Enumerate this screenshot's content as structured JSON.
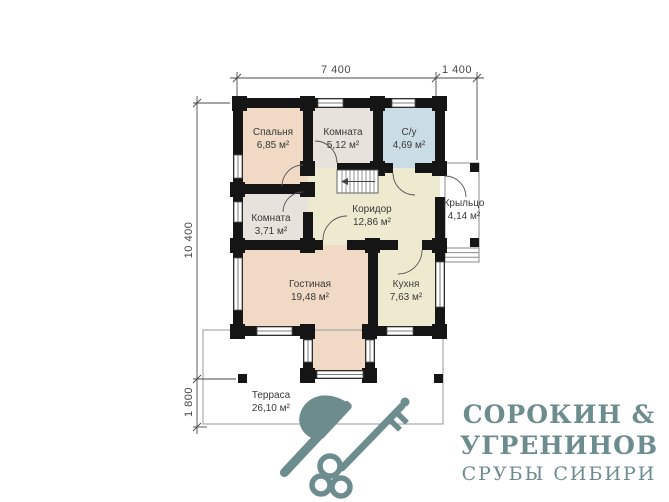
{
  "plan": {
    "rooms": [
      {
        "id": "bedroom",
        "name": "Спальня",
        "area": "6,85 м²"
      },
      {
        "id": "room-top",
        "name": "Комната",
        "area": "5,12 м²"
      },
      {
        "id": "bathroom",
        "name": "С/у",
        "area": "4,69 м²"
      },
      {
        "id": "room-mid",
        "name": "Комната",
        "area": "3,71 м²"
      },
      {
        "id": "corridor",
        "name": "Коридор",
        "area": "12,86 м²"
      },
      {
        "id": "porch",
        "name": "Крыльцо",
        "area": "4,14 м²"
      },
      {
        "id": "living",
        "name": "Гостиная",
        "area": "19,48 м²"
      },
      {
        "id": "kitchen",
        "name": "Кухня",
        "area": "7,63 м²"
      },
      {
        "id": "terrace",
        "name": "Терраса",
        "area": "26,10 м²"
      }
    ],
    "dimensions": {
      "top_main": "7 400",
      "top_right": "1 400",
      "left_main": "10 400",
      "left_bottom": "1 800"
    }
  },
  "logo": {
    "line1": "СОРОКИН &",
    "line2": "УГРЕНИНОВ",
    "line3": "СРУБЫ СИБИРИ"
  },
  "colors": {
    "wall": "#151515",
    "bedroom_fill": "#f0d9c5",
    "room_fill": "#e7e3dc",
    "bathroom_fill": "#cbdde4",
    "corridor_fill": "#eeead0",
    "living_fill": "#f0d9c5",
    "kitchen_fill": "#eeead0",
    "brand": "#6d8c8e"
  }
}
